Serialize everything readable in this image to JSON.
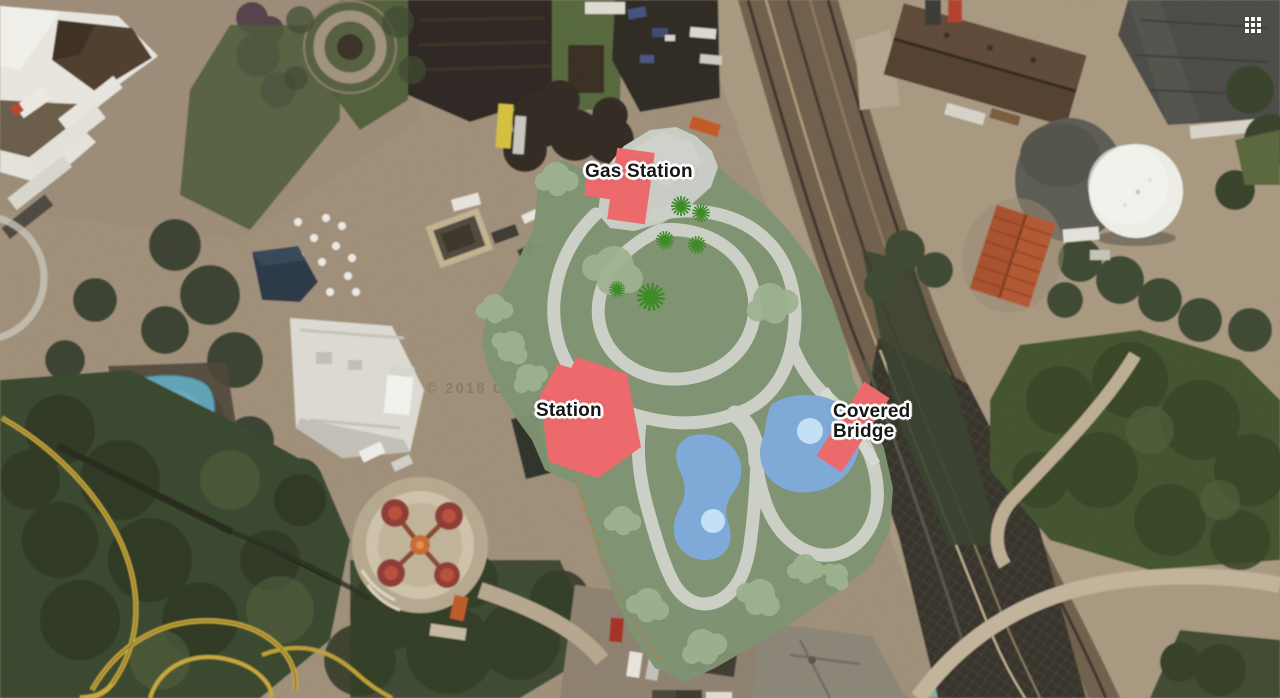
{
  "view": {
    "type": "satellite-map",
    "watermark": "© 2018 Go",
    "apps_grid_icon": "apps-grid-3x3"
  },
  "overlay": {
    "labels": {
      "gas_station": "Gas Station",
      "station": "Station",
      "covered_bridge": {
        "full": "Covered Bridge",
        "line1": "Covered",
        "line2": "Bridge"
      }
    },
    "colors": {
      "area_green": "#7F9372",
      "tree_blob_green": "#9DB190",
      "conifer_green": "#3E8C28",
      "track_gray": "#CBCFC6",
      "plaza_gray": "#C9CCC4",
      "building_red": "#EC6A6C",
      "pond_blue": "#7FA9D6",
      "pond_highlight": "#C3E0F5"
    },
    "features": {
      "buildings": [
        "Gas Station",
        "Station",
        "Covered Bridge"
      ],
      "pond_count": 2,
      "conifer_count": 6
    }
  }
}
